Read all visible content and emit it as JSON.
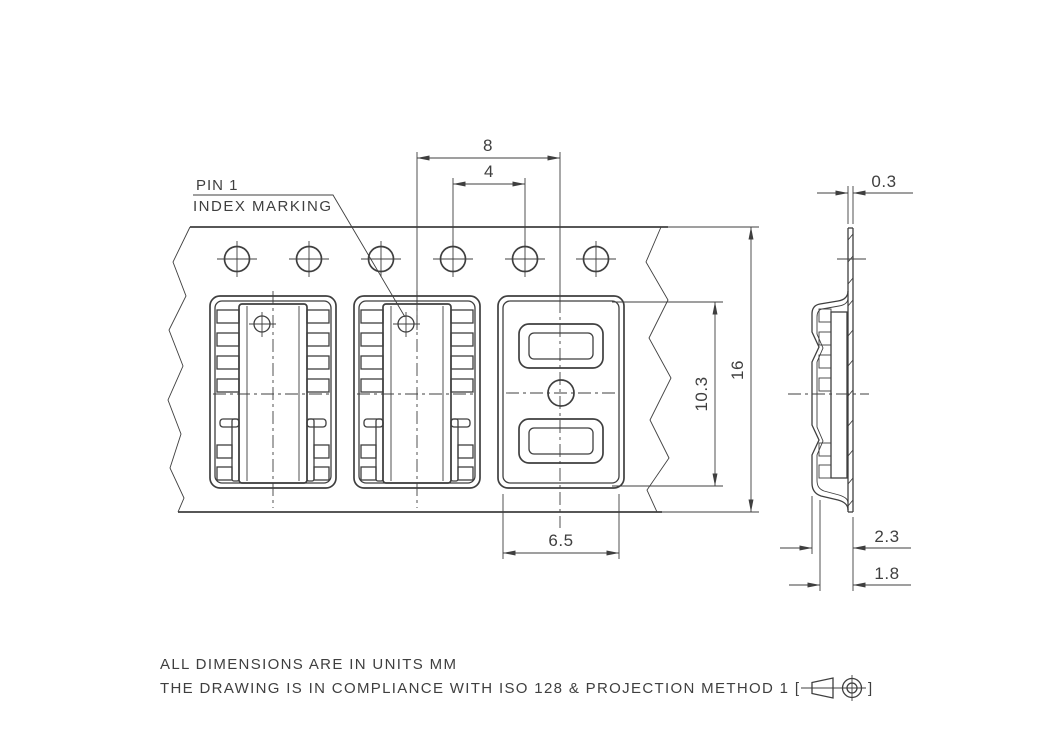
{
  "colors": {
    "line": "#3f3f3f",
    "background": "#ffffff"
  },
  "top_view": {
    "pin1_label": {
      "line1": "PIN 1",
      "line2": "INDEX MARKING"
    },
    "dims": {
      "pocket_pitch": "8",
      "sprocket_hole_pitch": "4",
      "pocket_width": "6.5",
      "pocket_length": "10.3",
      "tape_width": "16"
    }
  },
  "side_view": {
    "dims": {
      "tape_thickness": "0.3",
      "emboss_height": "2.3",
      "pocket_depth": "1.8"
    }
  },
  "notes": {
    "line1": "ALL DIMENSIONS ARE IN UNITS MM",
    "line2": "THE DRAWING IS IN COMPLIANCE WITH ISO 128 & PROJECTION METHOD 1 [",
    "line2_close": "]"
  }
}
